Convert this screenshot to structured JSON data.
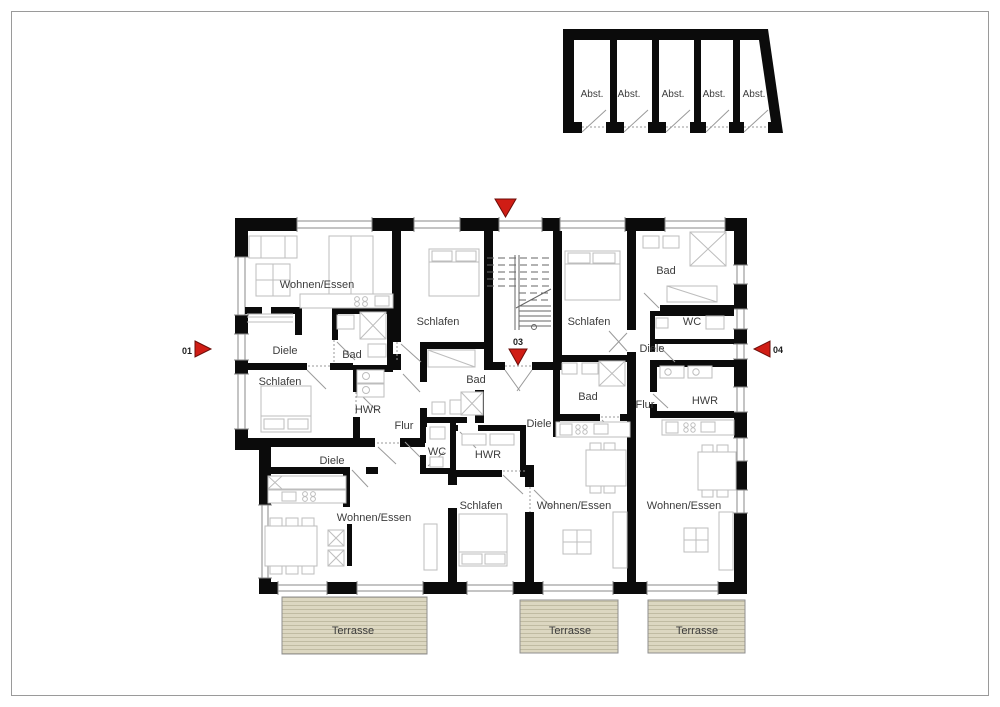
{
  "colors": {
    "wall": "#0b0b0b",
    "furniture_line": "#bdbdbd",
    "door_line": "#9a9a9a",
    "text": "#3c3c3c",
    "marker_red": "#d01d15",
    "terrace_fill": "#dcd7c1",
    "terrace_stripe": "#c0bba2",
    "frame": "#9a9a9a"
  },
  "storage": {
    "units": [
      "Abst.",
      "Abst.",
      "Abst.",
      "Abst.",
      "Abst."
    ]
  },
  "rooms": [
    {
      "label": "Wohnen/Essen"
    },
    {
      "label": "Diele"
    },
    {
      "label": "Bad"
    },
    {
      "label": "Schlafen"
    },
    {
      "label": "HWR"
    },
    {
      "label": "Flur"
    },
    {
      "label": "Schlafen"
    },
    {
      "label": "Bad"
    },
    {
      "label": "WC"
    },
    {
      "label": "HWR"
    },
    {
      "label": "Schlafen"
    },
    {
      "label": "Diele"
    },
    {
      "label": "Wohnen/Essen"
    },
    {
      "label": "Schlafen"
    },
    {
      "label": "Bad"
    },
    {
      "label": "WC"
    },
    {
      "label": "Diele"
    },
    {
      "label": "Bad"
    },
    {
      "label": "Diele"
    },
    {
      "label": "Flur"
    },
    {
      "label": "HWR"
    },
    {
      "label": "Wohnen/Essen"
    },
    {
      "label": "Wohnen/Essen"
    }
  ],
  "markers": [
    {
      "label": "01",
      "direction": "right"
    },
    {
      "label": "",
      "direction": "down"
    },
    {
      "label": "03",
      "direction": "down"
    },
    {
      "label": "04",
      "direction": "left"
    }
  ],
  "terraces": [
    {
      "label": "Terrasse"
    },
    {
      "label": "Terrasse"
    },
    {
      "label": "Terrasse"
    }
  ]
}
